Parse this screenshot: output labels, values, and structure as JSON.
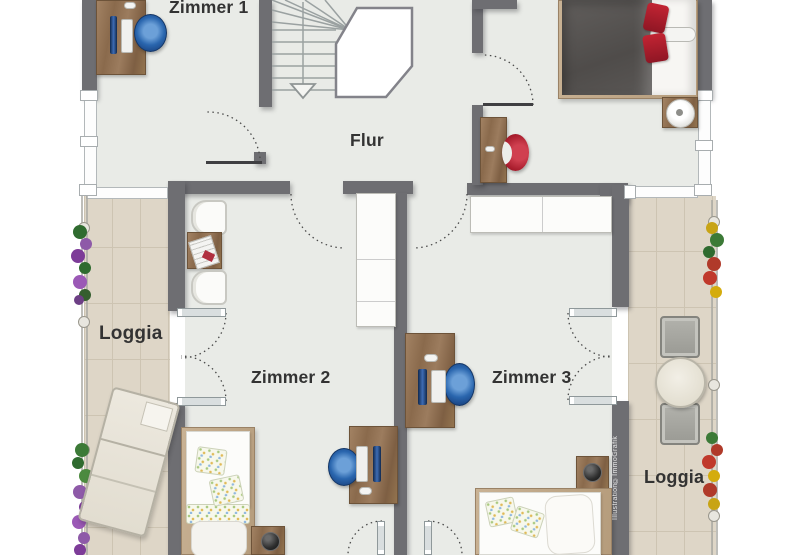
{
  "credit": {
    "text": "Illustration©ImmoGrafik"
  },
  "rooms": [
    {
      "id": "zimmer-1",
      "label": "Zimmer 1"
    },
    {
      "id": "flur",
      "label": "Flur"
    },
    {
      "id": "loggia-west",
      "label": "Loggia"
    },
    {
      "id": "zimmer-2",
      "label": "Zimmer 2"
    },
    {
      "id": "zimmer-3",
      "label": "Zimmer 3"
    },
    {
      "id": "loggia-sued",
      "label": "Loggia"
    }
  ],
  "furniture": [
    "staircase-down",
    "desk-with-monitor",
    "office-chair",
    "double-bed",
    "red-cushions",
    "white-bolster",
    "nightstand",
    "table-lamp",
    "vanity-console",
    "red-shell-chair",
    "armchair",
    "side-table",
    "newspaper",
    "wardrobe",
    "single-bed",
    "floral-cushions",
    "decorative-bowl",
    "sun-lounger",
    "bistro-table",
    "loggia-chairs",
    "planter-flowers",
    "french-double-door",
    "loggia-railing"
  ],
  "colors": {
    "background": "#ffffff",
    "wall": "#6e6e72",
    "room_floor": "#e9ebe7",
    "loggia_tile": "#ded6c7",
    "tile_grout": "#cdc4b2",
    "wood": "#96775a",
    "office_chair_blue": "#2a66ae",
    "accent_red": "#ae1f2e",
    "furniture_white": "#fbfbfa",
    "plant_green": "#3c7a37",
    "plant_purple": "#8e5aa8",
    "flower_red": "#c0392b",
    "flower_yellow": "#d4ac0d",
    "stair_line": "#9aa1a1",
    "label_text": "#333333"
  }
}
